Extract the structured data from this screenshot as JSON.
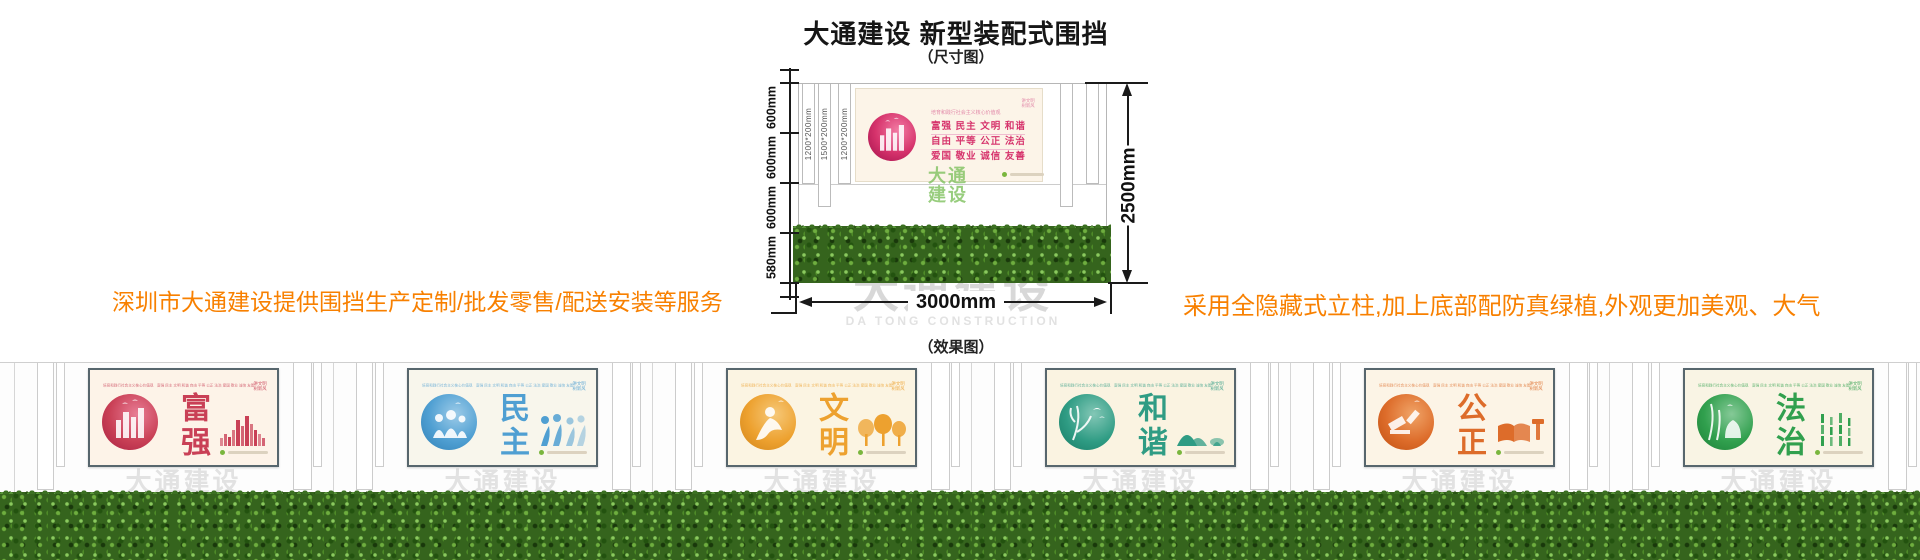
{
  "header": {
    "title": "大通建设 新型装配式围挡",
    "subtitle": "（尺寸图）",
    "effect_subtitle": "（效果图）"
  },
  "annotations": {
    "left": "深圳市大通建设提供围挡生产定制/批发零售/配送安装等服务",
    "right": "采用全隐藏式立柱,加上底部配防真绿植,外观更加美观、大气",
    "color": "#f88000"
  },
  "diagram": {
    "left_dims": [
      "600mm",
      "600mm",
      "600mm",
      "580mm"
    ],
    "slat_labels": [
      "1200*200mm",
      "1500*200mm",
      "1200*200mm"
    ],
    "total_height": "2500mm",
    "total_width": "3000mm",
    "sign": {
      "slogan": "培育和践行社会主义核心价值观",
      "corner": [
        "讲文明",
        "树新风"
      ],
      "rows": [
        "富强  民主  文明  和谐",
        "自由  平等  公正  法治",
        "爱国  敬业  诚信  友善"
      ],
      "accent": "#d6336c"
    }
  },
  "watermark": {
    "cn": "大通建设",
    "en": "DA TONG CONSTRUCTION"
  },
  "effect": {
    "slogan_row": "培育和践行社会主义核心价值观　富强 民主 文明 和谐 自由 平等 公正 法治 爱国 敬业 诚信 友善",
    "corner": [
      "讲文明",
      "树新风"
    ],
    "panels": [
      {
        "word": "富强",
        "motif": "city-skyline",
        "accent": "#c94056",
        "accent_dark": "#a81f42",
        "accent_light": "#e87d95",
        "bg": "#fdf3e8"
      },
      {
        "word": "民主",
        "motif": "people-holding-hands",
        "accent": "#4f9fd2",
        "accent_dark": "#2f7fb5",
        "accent_light": "#9ccbe8",
        "bg": "#f8f6ec"
      },
      {
        "word": "文明",
        "motif": "dancing-figure-trees",
        "accent": "#eda12f",
        "accent_dark": "#d0831a",
        "accent_light": "#f6c878",
        "bg": "#fbf4e2"
      },
      {
        "word": "和谐",
        "motif": "birds-branches-hills",
        "accent": "#2f9c84",
        "accent_dark": "#177a64",
        "accent_light": "#83c7b6",
        "bg": "#faf3e1"
      },
      {
        "word": "公正",
        "motif": "gavel-book",
        "accent": "#dd6c2a",
        "accent_dark": "#bf4f12",
        "accent_light": "#f0a468",
        "bg": "#fcf4e6"
      },
      {
        "word": "法治",
        "motif": "bamboo-figure",
        "accent": "#31a04e",
        "accent_dark": "#1b7f37",
        "accent_light": "#85c997",
        "bg": "#f9f4e4"
      }
    ]
  }
}
